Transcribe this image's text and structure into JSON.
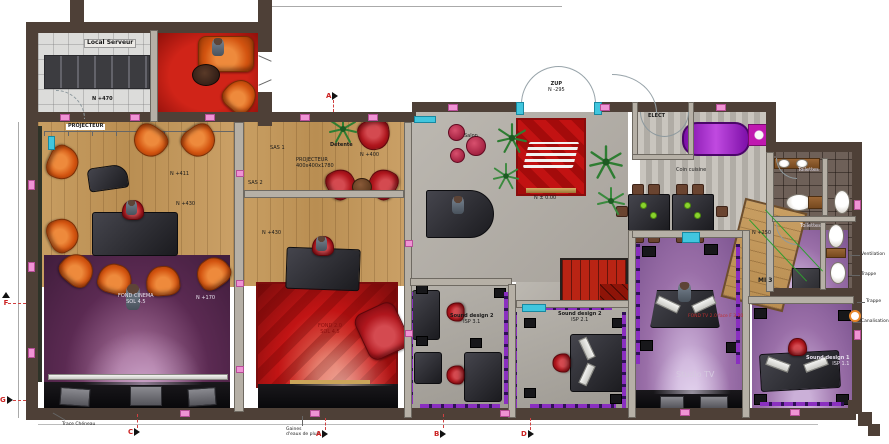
{
  "rooms": {
    "local_serveur": {
      "label": "Local Serveur",
      "level": "N +470"
    },
    "cinema": {
      "projecteur": "PROJECTEUR",
      "level_a": "N +411",
      "level_b": "N +430",
      "stage_line1": "FOND CINEMA",
      "stage_line2": "SOL 4.5",
      "level_c": "N +170"
    },
    "sas1": {
      "label": "SAS 1"
    },
    "sas2": {
      "label": "SAS 2"
    },
    "detente": {
      "label": "Détente",
      "proj_line1": "PROJECTEUR",
      "proj_line2": "400x400x1780",
      "level": "N +400"
    },
    "studio2": {
      "level": "N +430",
      "note_line1": "FOND 2.0",
      "note_line2": "SOL 4.5"
    },
    "hall": {
      "salon": "Salon",
      "zup": "ZUP",
      "zup_level": "N -295",
      "floor_level": "N ± 0.00",
      "coin_cuisine": "Coin cuisine"
    },
    "elect": {
      "label": "ELECT"
    },
    "bath": {
      "label1": "Toilettes",
      "label2": "Toilettes"
    },
    "ramp": {
      "level": "N +250",
      "tag": "MI 3"
    },
    "studio_tv": {
      "label": "Studio TV",
      "note": "FOND TV 2.0 face F 3.20"
    },
    "sound1": {
      "line1": "Sound design 1",
      "line2": "ISP 1.1"
    },
    "sound2a": {
      "line1": "Sound design 2",
      "line2": "ISP 3.1"
    },
    "sound2b": {
      "line1": "Sound design 2",
      "line2": "ISP 2.1"
    }
  },
  "annotations": {
    "gaines_line1": "Gaines",
    "gaines_line2": "d'eaux de pluie",
    "trace": "Trace Chéneau",
    "ventilation": "Ventilation",
    "trappe_a": "Trappe",
    "trappe_b": "Trappe",
    "canalisation": "Canalisation"
  },
  "markers": {
    "a": "A",
    "b": "B",
    "c": "C",
    "d": "D",
    "f": "F",
    "g": "G"
  },
  "colors": {
    "wall": "#4e4037",
    "wood": "#c49a5f",
    "purple_dark": "#5b2a52",
    "purple_light": "#9a6fa8",
    "red_carpet": "#c21616",
    "orange_chair": "#dd5d16",
    "red_chair": "#b5161d",
    "floor_grey": "#b8b4ad",
    "accent_pink": "#ee8fd2",
    "accent_cyan": "#3fc8e0",
    "accent_purple": "#8a2fc0"
  }
}
